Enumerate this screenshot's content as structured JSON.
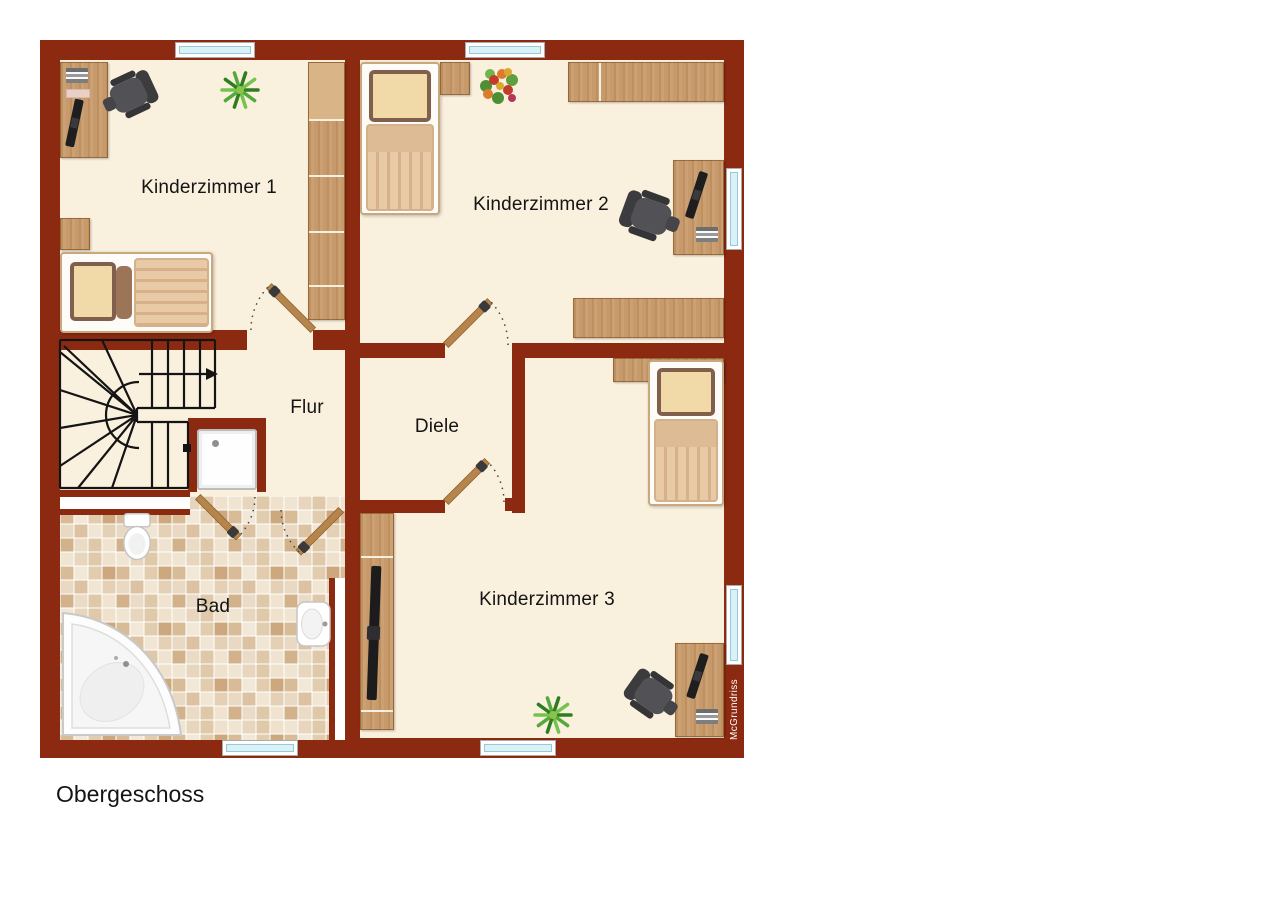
{
  "plan": {
    "floor_label": "Obergeschoss",
    "watermark": "McGrundriss",
    "rooms": [
      {
        "id": "kinderzimmer1",
        "label": "Kinderzimmer 1"
      },
      {
        "id": "kinderzimmer2",
        "label": "Kinderzimmer 2"
      },
      {
        "id": "kinderzimmer3",
        "label": "Kinderzimmer 3"
      },
      {
        "id": "flur",
        "label": "Flur"
      },
      {
        "id": "diele",
        "label": "Diele"
      },
      {
        "id": "bad",
        "label": "Bad"
      }
    ],
    "icons": {
      "furniture": [
        "bed-icon",
        "desk-icon",
        "office-chair-icon",
        "wardrobe-icon",
        "shelf-icon",
        "plant-icon",
        "flowers-icon",
        "tv-lowboard-icon"
      ],
      "fixtures": [
        "bathtub-icon",
        "toilet-icon",
        "sink-icon",
        "shower-icon",
        "stairs-icon",
        "door-icon",
        "window-icon"
      ]
    },
    "counts": {
      "windows": 6,
      "doors": 5,
      "beds": 3,
      "desks": 3,
      "chairs": 3
    },
    "colors": {
      "wall": "#8C2A11",
      "floor": "#FAF0DE",
      "wood": "#C79A6B",
      "door_wood": "#B5854C",
      "window_glass": "#D9F2F8",
      "tile_grout": "#FFFFFF",
      "stair_line": "#141414",
      "chair": "#515156",
      "label_ink": "#141414",
      "watermark_ink": "#FFFFFF"
    }
  }
}
